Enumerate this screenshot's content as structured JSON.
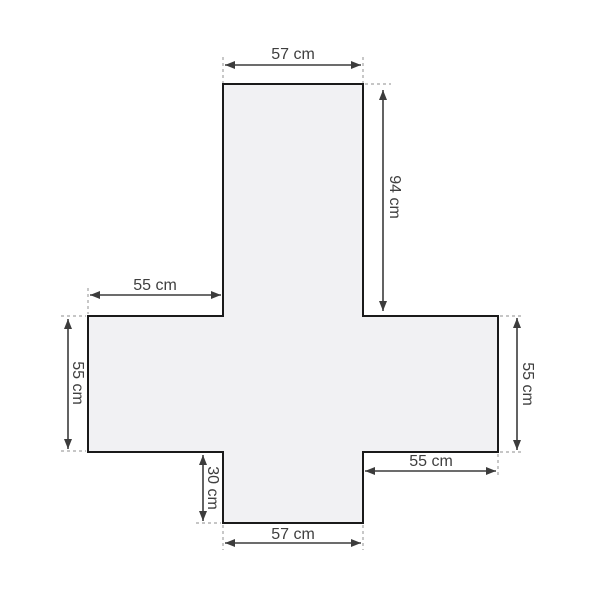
{
  "diagram": {
    "description": "Cross-shaped sofa cover sewing pattern with dimension annotations",
    "unit": "cm",
    "colors": {
      "background": "#ffffff",
      "shape_fill": "#f1f1f3",
      "shape_outline": "#1a1a1a",
      "dimension_line": "#3c3c3c",
      "extension_line": "#a3a3a3",
      "text": "#3f3f3f"
    },
    "measurements": {
      "top_width": {
        "label": "57 cm",
        "value": 57
      },
      "top_arm_height": {
        "label": "94 cm",
        "value": 94
      },
      "left_arm_width": {
        "label": "55 cm",
        "value": 55
      },
      "left_side_height": {
        "label": "55 cm",
        "value": 55
      },
      "right_side_height": {
        "label": "55 cm",
        "value": 55
      },
      "right_arm_width": {
        "label": "55 cm",
        "value": 55
      },
      "bottom_notch_height": {
        "label": "30 cm",
        "value": 30
      },
      "bottom_width": {
        "label": "57 cm",
        "value": 57
      }
    }
  }
}
